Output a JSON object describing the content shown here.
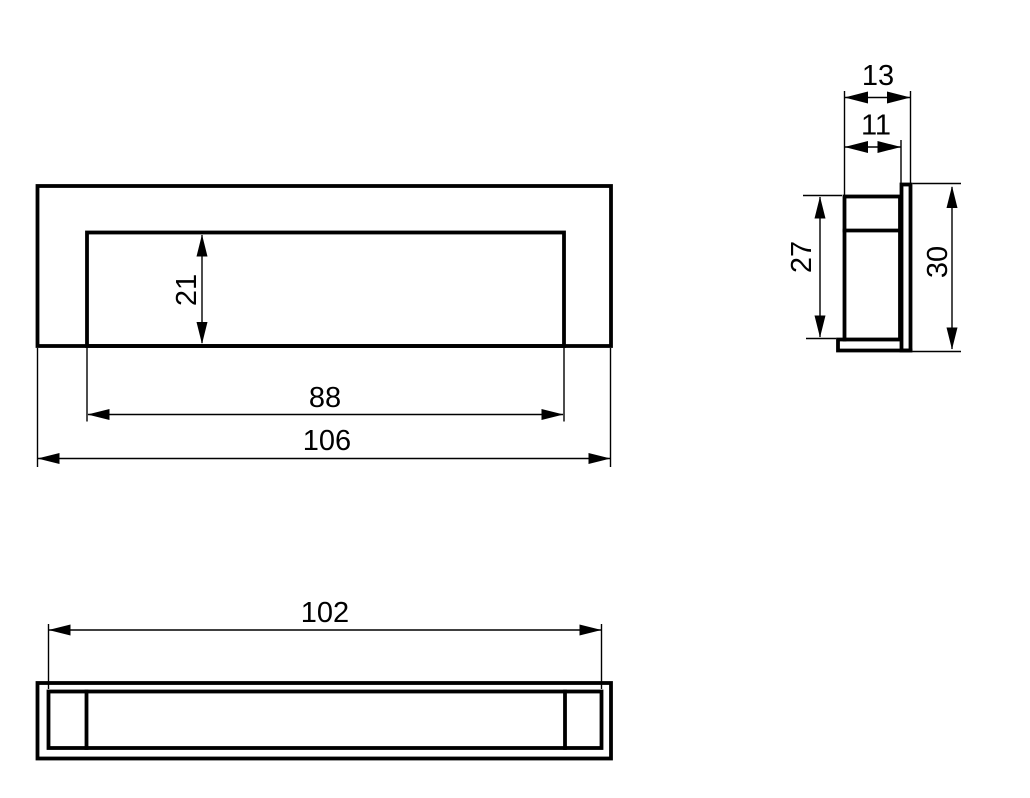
{
  "drawing": {
    "type": "technical-dimension-drawing",
    "colors": {
      "line": "#000000",
      "background": "#ffffff"
    },
    "views": {
      "front": {
        "dims": {
          "recess_height": "21",
          "recess_width": "88",
          "overall_width": "106"
        }
      },
      "side": {
        "dims": {
          "overall_depth": "13",
          "inner_depth": "11",
          "body_height": "27",
          "overall_height": "30"
        }
      },
      "bottom": {
        "dims": {
          "inner_length": "102"
        }
      }
    }
  }
}
